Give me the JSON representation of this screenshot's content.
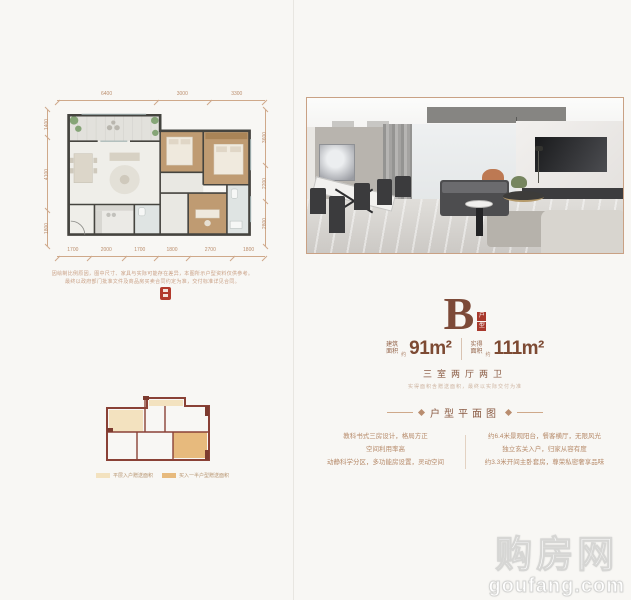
{
  "page": {
    "background": "#f8f7f4",
    "accent_brown": "#8a5b43",
    "dark_brown": "#7d4a33",
    "seal_red": "#a8392c"
  },
  "floor_plan": {
    "dims_top": [
      "6400",
      "3000",
      "3300"
    ],
    "dims_bottom": [
      "1700",
      "2000",
      "1700",
      "1800",
      "2700",
      "1800"
    ],
    "dims_left": [
      "1400",
      "4100",
      "1800"
    ],
    "dims_right": [
      "3600",
      "2200",
      "2800"
    ],
    "disclaimer_line1": "因绘制比例原因，图中尺寸、家具与实际可能存在差异，本图所示户型资料仅供参考。",
    "disclaimer_line2": "最终以政府部门批准文件及商品房买卖合同约定为准，交付标准详见合同。"
  },
  "unit": {
    "letter": "B",
    "badge_chars": [
      "户",
      "型"
    ],
    "area1_label_l1": "建筑",
    "area1_label_l2": "面积",
    "area1_approx": "约",
    "area1_value": "91m²",
    "area2_label_l1": "实得",
    "area2_label_l2": "面积",
    "area2_approx": "约",
    "area2_value": "111m²",
    "layout_text": "三室两厅两卫",
    "area_note": "实得面积含赠送面积，最终以实际交付为准"
  },
  "section": {
    "title": "户型平面图"
  },
  "features": {
    "left": [
      "教科书式三房设计，格局方正",
      "空间利用率高",
      "动静科学分区，多功能房设置，灵动空间"
    ],
    "right": [
      "约6.4米景观阳台，餐客横厅，无限风光",
      "独立玄关入户，归家从容有度",
      "约3.3米开间主卧套房，尊荣私密奢享品味"
    ]
  },
  "mini_plan": {
    "legend": [
      {
        "label": "平层入户赠送面积",
        "color": "#f3e2bf"
      },
      {
        "label": "买入一半户型赠送面积",
        "color": "#e7ba7d"
      }
    ]
  },
  "watermark": {
    "line1": "购房网",
    "line2": "goufang.com"
  }
}
